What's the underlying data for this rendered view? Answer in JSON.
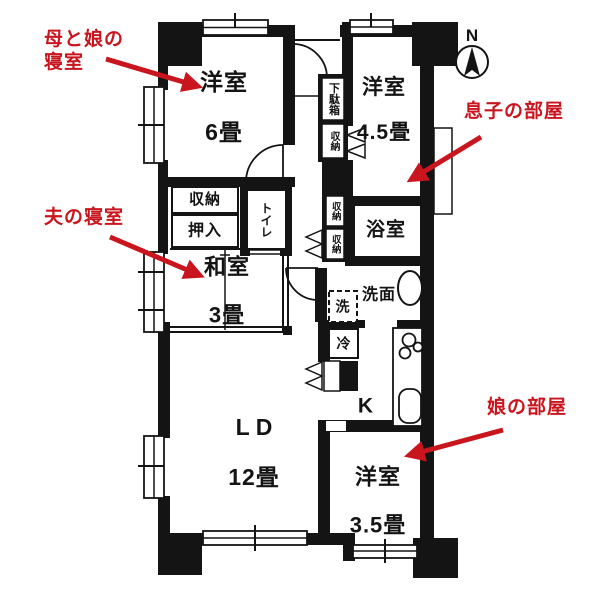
{
  "annotations": {
    "color": "#c9151e",
    "mother_bedroom": "母と娘の\n寝室",
    "husband_bedroom": "夫の寝室",
    "son_room": "息子の部屋",
    "daughter_room": "娘の部屋"
  },
  "compass": {
    "north": "N"
  },
  "rooms": {
    "western6": {
      "name": "洋室",
      "size": "6畳"
    },
    "western45": {
      "name": "洋室",
      "size": "4.5畳"
    },
    "japanese3": {
      "name": "和室",
      "size": "3畳"
    },
    "living": {
      "name": "LD",
      "size": "12畳"
    },
    "western35": {
      "name": "洋室",
      "size": "3.5畳"
    },
    "bath": {
      "name": "浴室"
    },
    "kitchen": {
      "name": "K"
    }
  },
  "labels": {
    "washroom": "洗面",
    "washer": "洗",
    "fridge": "冷",
    "closet": "収納",
    "futon_closet": "押入",
    "toilet": "トイレ",
    "shoe_box": "下駄箱",
    "entry_closet": "収納",
    "hall_closet_1": "収納",
    "hall_closet_2": "収納"
  }
}
